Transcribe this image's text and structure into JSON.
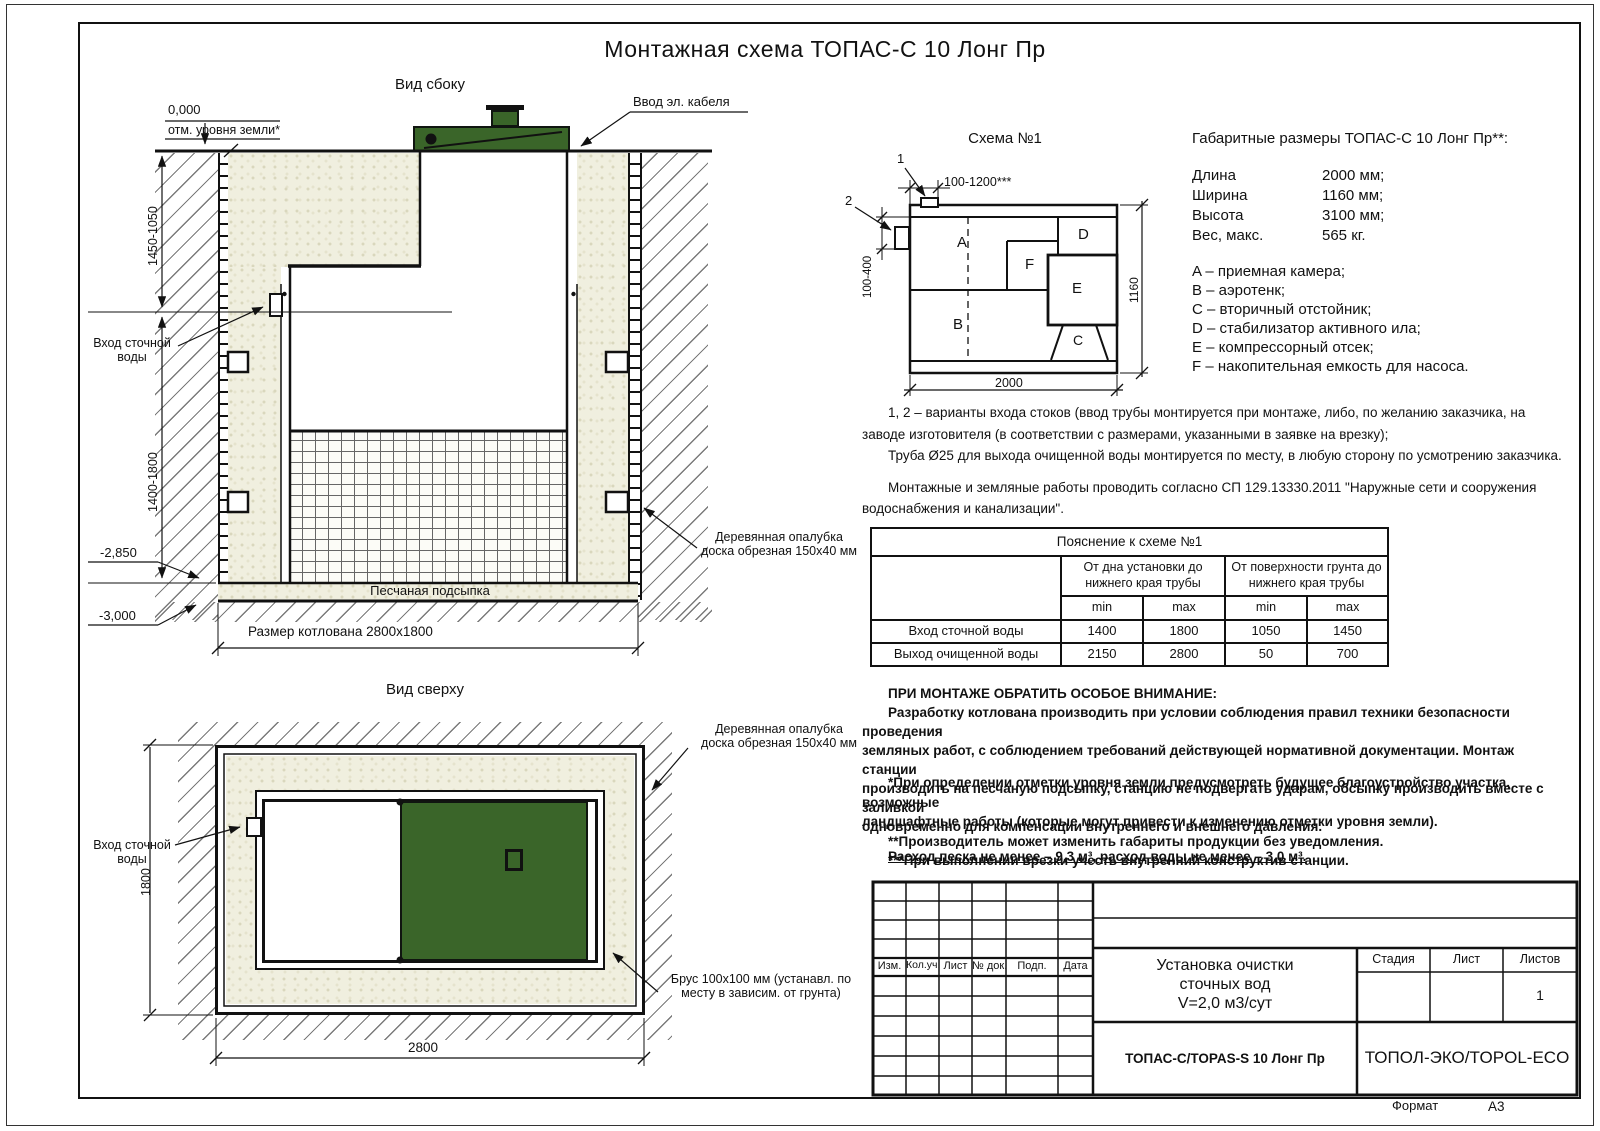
{
  "page": {
    "title": "Монтажная схема ТОПАС-С 10 Лонг Пр",
    "format_label": "Формат",
    "format_value": "А3"
  },
  "side_view": {
    "title": "Вид сбоку",
    "zero_mark": "0,000",
    "ground_note": "отм. уровня земли*",
    "cable_label": "Ввод эл. кабеля",
    "inlet_l1": "Вход сточной",
    "inlet_l2": "воды",
    "dim_upper": "1450-1050",
    "dim_lower": "1400-1800",
    "mark_2850": "-2,850",
    "mark_3000": "-3,000",
    "sand_bed": "Песчаная подсыпка",
    "pit_size": "Размер котлована 2800х1800",
    "formwork_l1": "Деревянная опалубка",
    "formwork_l2": "доска обрезная 150х40 мм"
  },
  "top_view": {
    "title": "Вид сверху",
    "inlet_l1": "Вход сточной",
    "inlet_l2": "воды",
    "dim_height": "1800",
    "dim_width": "2800",
    "formwork_l1": "Деревянная опалубка",
    "formwork_l2": "доска обрезная 150х40 мм",
    "beam_l1": "Брус 100х100 мм (устанавл. по",
    "beam_l2": "месту в зависим. от грунта)"
  },
  "schema": {
    "title": "Схема №1",
    "ref1": "1",
    "ref2": "2",
    "dim_top": "100-1200***",
    "dim_left": "100-400",
    "dim_width": "2000",
    "dim_height": "1160",
    "comp_a": "A",
    "comp_b": "B",
    "comp_c": "C",
    "comp_d": "D",
    "comp_e": "E",
    "comp_f": "F"
  },
  "specs": {
    "title": "Габаритные размеры ТОПАС-С 10 Лонг Пр**:",
    "rows": [
      {
        "label": "Длина",
        "value": "2000 мм;"
      },
      {
        "label": "Ширина",
        "value": "1160 мм;"
      },
      {
        "label": "Высота",
        "value": "3100 мм;"
      },
      {
        "label": "Вес, макс.",
        "value": "565 кг."
      }
    ]
  },
  "legend": [
    "A – приемная камера;",
    "B – аэротенк;",
    "C – вторичный отстойник;",
    "D – стабилизатор активного ила;",
    "E – компрессорный отсек;",
    "F – накопительная емкость для насоса."
  ],
  "notes_variants": [
    "1, 2 – варианты входа  стоков (ввод трубы монтируется при монтаже, либо, по желанию заказчика, на",
    "заводе изготовителя (в соответствии с размерами, указанными в заявке на врезку);",
    "Труба Ø25 для выхода очищенной воды монтируется по месту, в любую сторону по усмотрению заказчика."
  ],
  "notes_mounting": [
    "Монтажные и земляные работы проводить согласно СП 129.13330.2011 \"Наружные сети и сооружения",
    "водоснабжения и канализации\"."
  ],
  "table": {
    "title": "Пояснение к схеме №1",
    "col_bottom": "От дна установки до нижнего края трубы",
    "col_surface": "От поверхности грунта до нижнего края трубы",
    "min1": "min",
    "max1": "max",
    "min2": "min",
    "max2": "max",
    "rows": [
      {
        "label": "Вход сточной воды",
        "values": [
          "1400",
          "1800",
          "1050",
          "1450"
        ]
      },
      {
        "label": "Выход очищенной воды",
        "values": [
          "2150",
          "2800",
          "50",
          "700"
        ]
      }
    ]
  },
  "attention": {
    "header": "ПРИ МОНТАЖЕ ОБРАТИТЬ ОСОБОЕ ВНИМАНИЕ:",
    "lines": [
      "Разработку котлована производить при условии соблюдения правил техники безопасности проведения",
      "земляных работ, с соблюдением требований действующей нормативной документации. Монтаж станции",
      "производить на песчаную подсыпку, станцию не подвергать ударам, обсыпку производить вместе с заливкой",
      "одновременно для компенсации внутреннего и внешнего давления."
    ]
  },
  "footnotes": [
    "*При определении отметки уровня земли предусмотреть будущее благоустройство участка, возможные",
    "ландшафтные работы (которые могут привести к изменению отметки уровня земли).",
    "**Производитель может изменить габариты продукции без уведомления.",
    "***При выполнении врезки учесть внутренний конструктив станции."
  ],
  "consumption": "Расход песка не менее – 9,3 м³, расход воды не менее – 3,0 м³.",
  "title_block": {
    "cols": [
      "Изм.",
      "Кол.уч.",
      "Лист",
      "№ док.",
      "Подп.",
      "Дата"
    ],
    "doc_l1": "Установка очистки",
    "doc_l2": "сточных вод",
    "doc_l3": "V=2,0 м3/сут",
    "stage": "Стадия",
    "sheet": "Лист",
    "sheets": "Листов",
    "sheets_value": "1",
    "product": "ТОПАС-С/TOPAS-S 10 Лонг Пр",
    "company": "ТОПОЛ-ЭКО/TOPOL-ECO"
  },
  "colors": {
    "green": "#3a6529",
    "sand": "#f0efdf"
  }
}
